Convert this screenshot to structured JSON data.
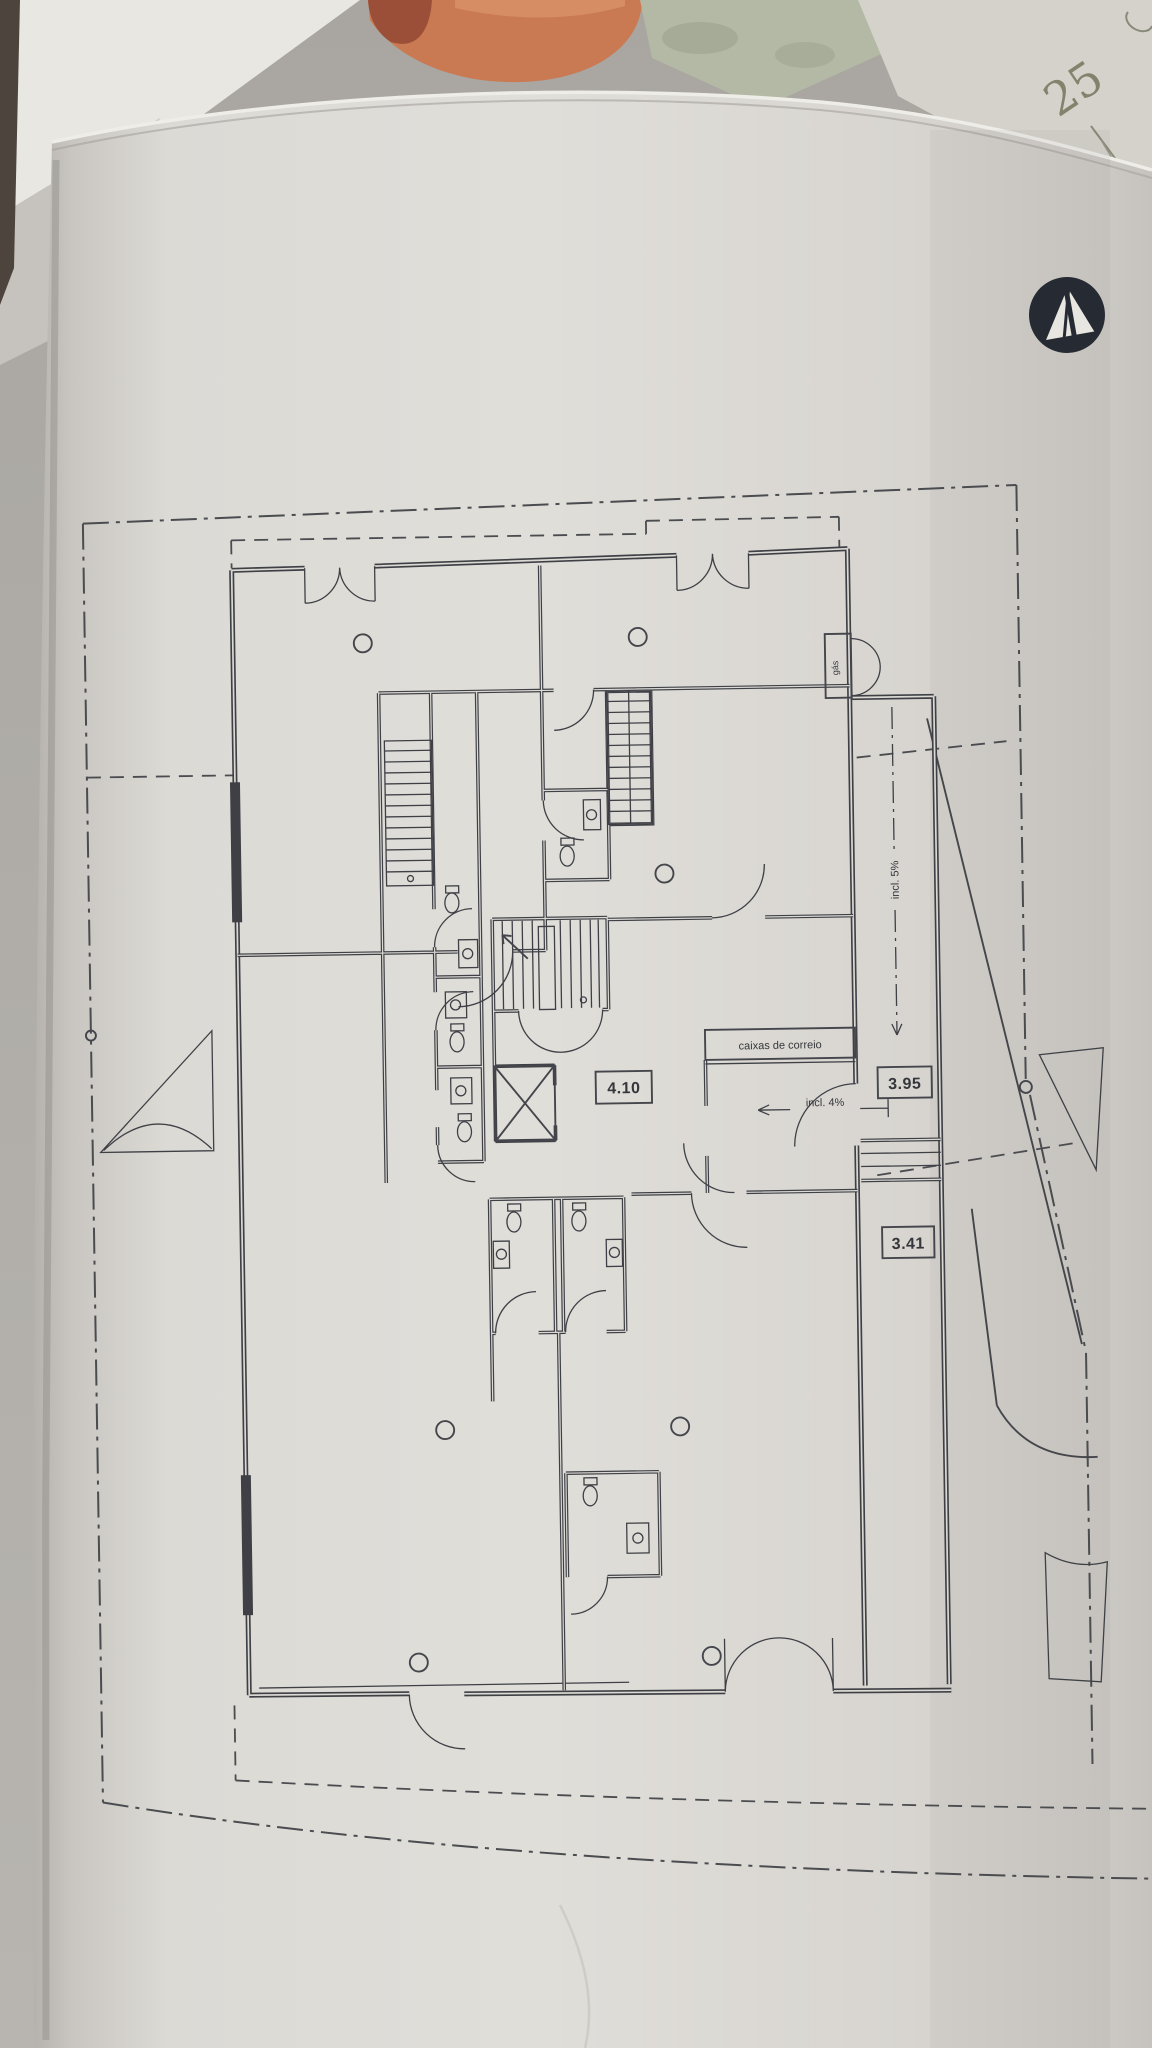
{
  "plan": {
    "labels": {
      "mailboxes": "caixas de correio",
      "dim_hall": "4.10",
      "dim_ramp_upper": "3.95",
      "dim_ramp_lower": "3.41",
      "slope_entry": "incl. 4%",
      "slope_ramp": "incl. 5%",
      "niche": "gás"
    }
  },
  "background_sheet": {
    "corner_note": "25"
  },
  "colors": {
    "paper": "#dedcd7",
    "ink": "#3e4046",
    "logo": "#262b33",
    "tile": "#c97a52",
    "tile_dark": "#9c4f38",
    "folder": "#b3b9a4",
    "backsheet": "#d4d2cb",
    "frame_white": "#e9e7e2"
  }
}
